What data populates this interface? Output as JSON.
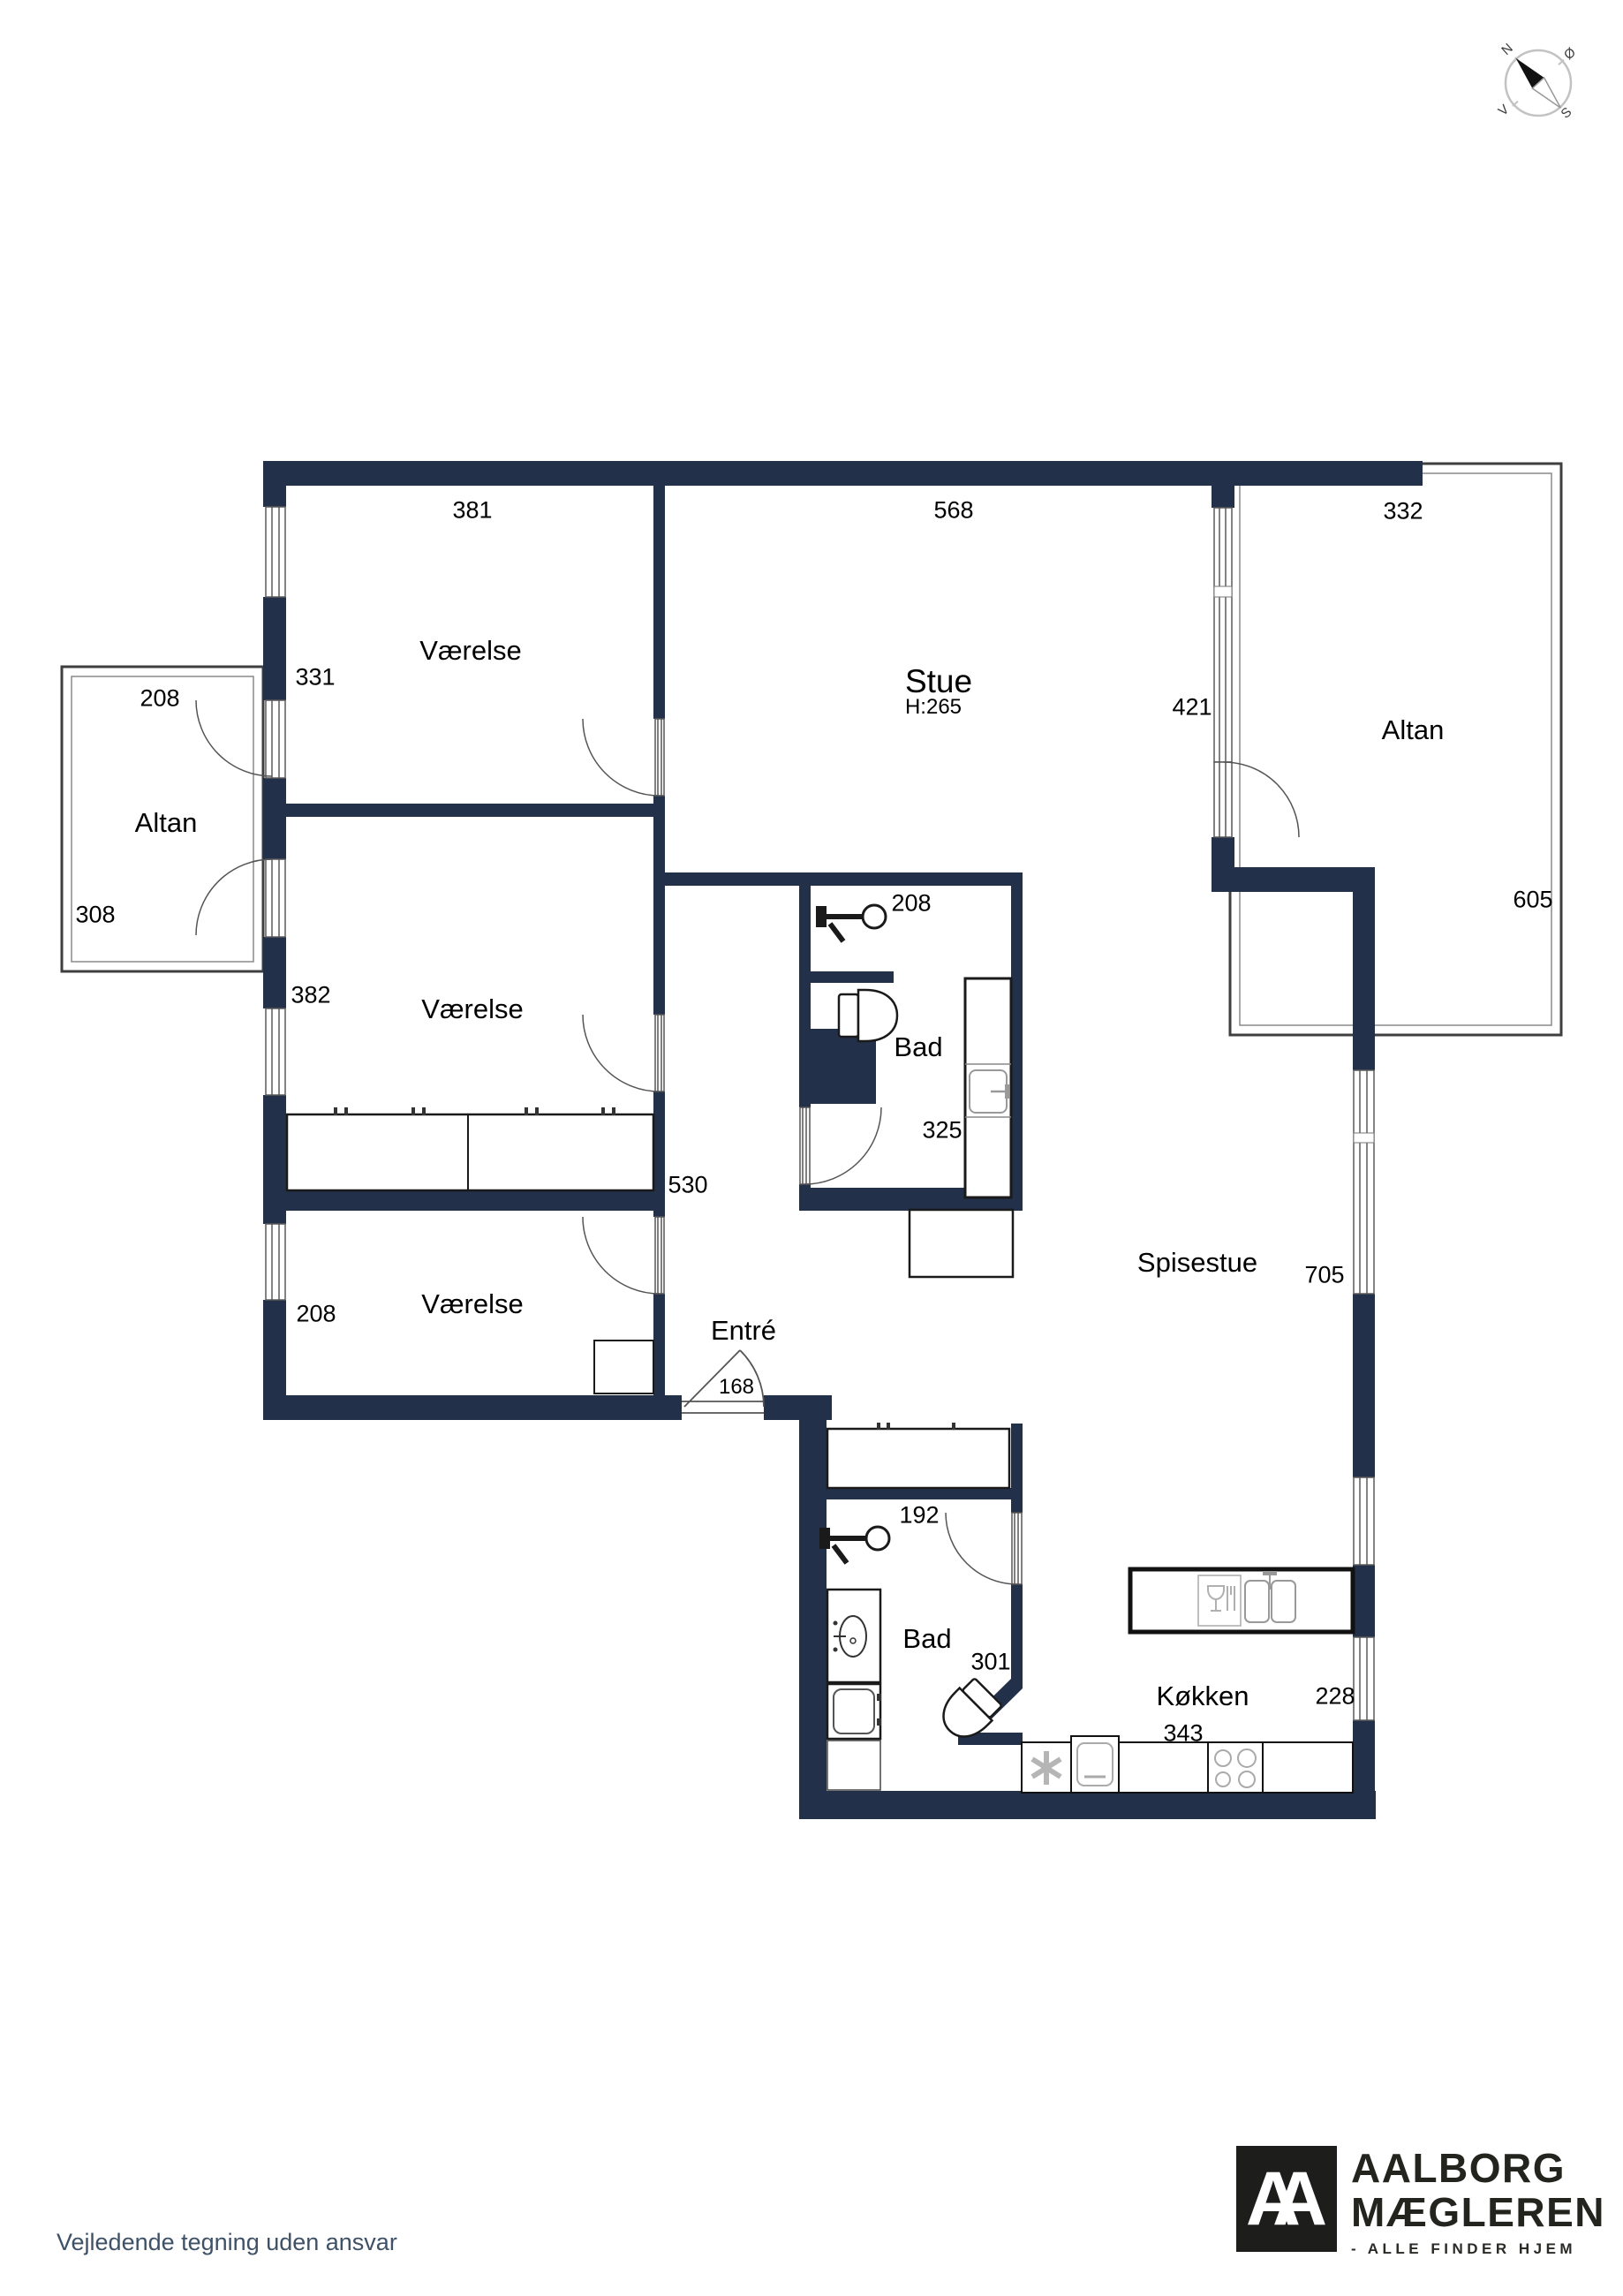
{
  "rooms": {
    "v1": "Værelse",
    "v2": "Værelse",
    "v3": "Værelse",
    "stue": "Stue",
    "stue_height": "H:265",
    "altan_left": "Altan",
    "altan_right": "Altan",
    "bad1": "Bad",
    "bad2": "Bad",
    "entre": "Entré",
    "spisestue": "Spisestue",
    "koekken": "Køkken"
  },
  "dims": {
    "v1_top": "381",
    "stue_top": "568",
    "altan_r_top": "332",
    "v1_left": "331",
    "altan_l_top": "208",
    "stue_right": "421",
    "altan_l_bottom": "308",
    "altan_r_right": "605",
    "v2_left": "382",
    "bad1_top": "208",
    "bad1_bottom": "325",
    "corridor": "530",
    "v3_left": "208",
    "entre_door": "168",
    "spisestue_right": "705",
    "bad2_top": "192",
    "bad2_bottom": "301",
    "koekken_right": "228",
    "koekken_bottom": "343"
  },
  "compass": {
    "n": "N",
    "oe": "Ø",
    "s": "S",
    "v": "V"
  },
  "footer": {
    "disclaimer": "Vejledende tegning uden ansvar"
  },
  "logo": {
    "monogram": "AA",
    "line1": "AALBORG",
    "line2": "MÆGLEREN",
    "tagline": "- ALLE FINDER HJEM"
  },
  "colors": {
    "wall": "#233049",
    "footer_text": "#3e5166",
    "logo_black": "#1d1d1b"
  }
}
